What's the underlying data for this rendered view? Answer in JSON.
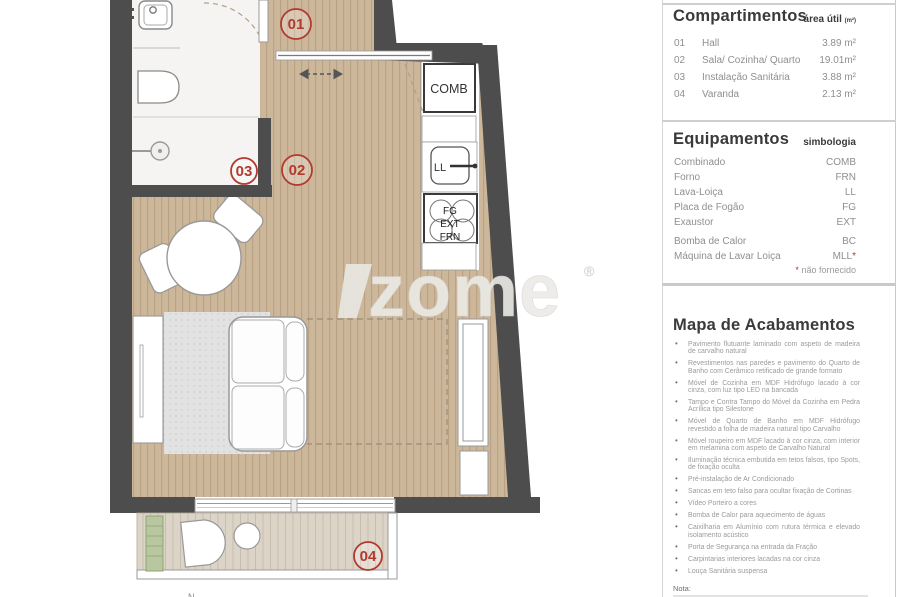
{
  "colors": {
    "wall": "#4d4d4d",
    "wood_floor": "#cdb79b",
    "deck_floor": "#ddd4c8",
    "accent_red": "#b23a2e",
    "legend_text_gray": "#8f8f8f"
  },
  "plan": {
    "room_labels": {
      "hall": "01",
      "living": "02",
      "bath": "03",
      "balcony": "04"
    },
    "appliances": {
      "comb": "COMB",
      "ll": "LL",
      "fg": "FG",
      "ext": "EXT",
      "frn": "FRN"
    },
    "watermark": {
      "text": "zome",
      "reg": "®"
    },
    "cutoff_label": "N"
  },
  "legend": {
    "compartimentos": {
      "title": "Compartimentos",
      "subtitle": "área útil",
      "subtitle_unit": "(m²)",
      "rows": [
        {
          "num": "01",
          "name": "Hall",
          "area": "3.89 m²"
        },
        {
          "num": "02",
          "name": "Sala/ Cozinha/ Quarto",
          "area": "19.01m²"
        },
        {
          "num": "03",
          "name": "Instalação Sanitária",
          "area": "3.88 m²"
        },
        {
          "num": "04",
          "name": "Varanda",
          "area": "2.13 m²"
        }
      ]
    },
    "equipamentos": {
      "title": "Equipamentos",
      "subtitle": "simbologia",
      "rows": [
        {
          "name": "Combinado",
          "symbol": "COMB",
          "star": ""
        },
        {
          "name": "Forno",
          "symbol": "FRN",
          "star": ""
        },
        {
          "name": "Lava-Loiça",
          "symbol": "LL",
          "star": ""
        },
        {
          "name": "Placa de Fogão",
          "symbol": "FG",
          "star": ""
        },
        {
          "name": "Exaustor",
          "symbol": "EXT",
          "star": ""
        },
        {
          "name": "Bomba de Calor",
          "symbol": "BC",
          "star": ""
        },
        {
          "name": "Máquina de Lavar Loiça",
          "symbol": "MLL",
          "star": "*"
        }
      ],
      "footnote_star": "*",
      "footnote": "não fornecido"
    },
    "acabamentos": {
      "title": "Mapa de Acabamentos",
      "items": [
        "Pavimento flutuante laminado com aspeto de madeira de carvalho natural",
        "Revestimentos nas paredes e pavimento do Quarto de Banho com Cerâmico retificado de grande formato",
        "Móvel de Cozinha em MDF Hidrófugo lacado à cor cinza, com luz tipo LED na bancada",
        "Tampo e Contra Tampo do Móvel da Cozinha em Pedra Acrílica tipo Silestone",
        "Móvel de Quarto de Banho em MDF Hidrófugo revestido a folha de madeira natural tipo Carvalho",
        "Móvel roupeiro em MDF lacado à cor cinza, com interior em melamina com aspeto de Carvalho Natural",
        "Iluminação técnica embutida em tetos falsos, tipo Spots, de fixação oculta",
        "Pré-instalação de Ar Condicionado",
        "Sancas em teto falso para ocultar fixação de Cortinas",
        "Vídeo Porteiro a cores",
        "Bomba de Calor para aquecimento de águas",
        "Caixilharia em Alumínio com rutura térmica e elevado isolamento acústico",
        "Porta de Segurança na entrada da Fração",
        "Carpintarias interiores lacadas na cor cinza",
        "Louça Sanitária suspensa"
      ]
    },
    "nota": "Nota:"
  }
}
